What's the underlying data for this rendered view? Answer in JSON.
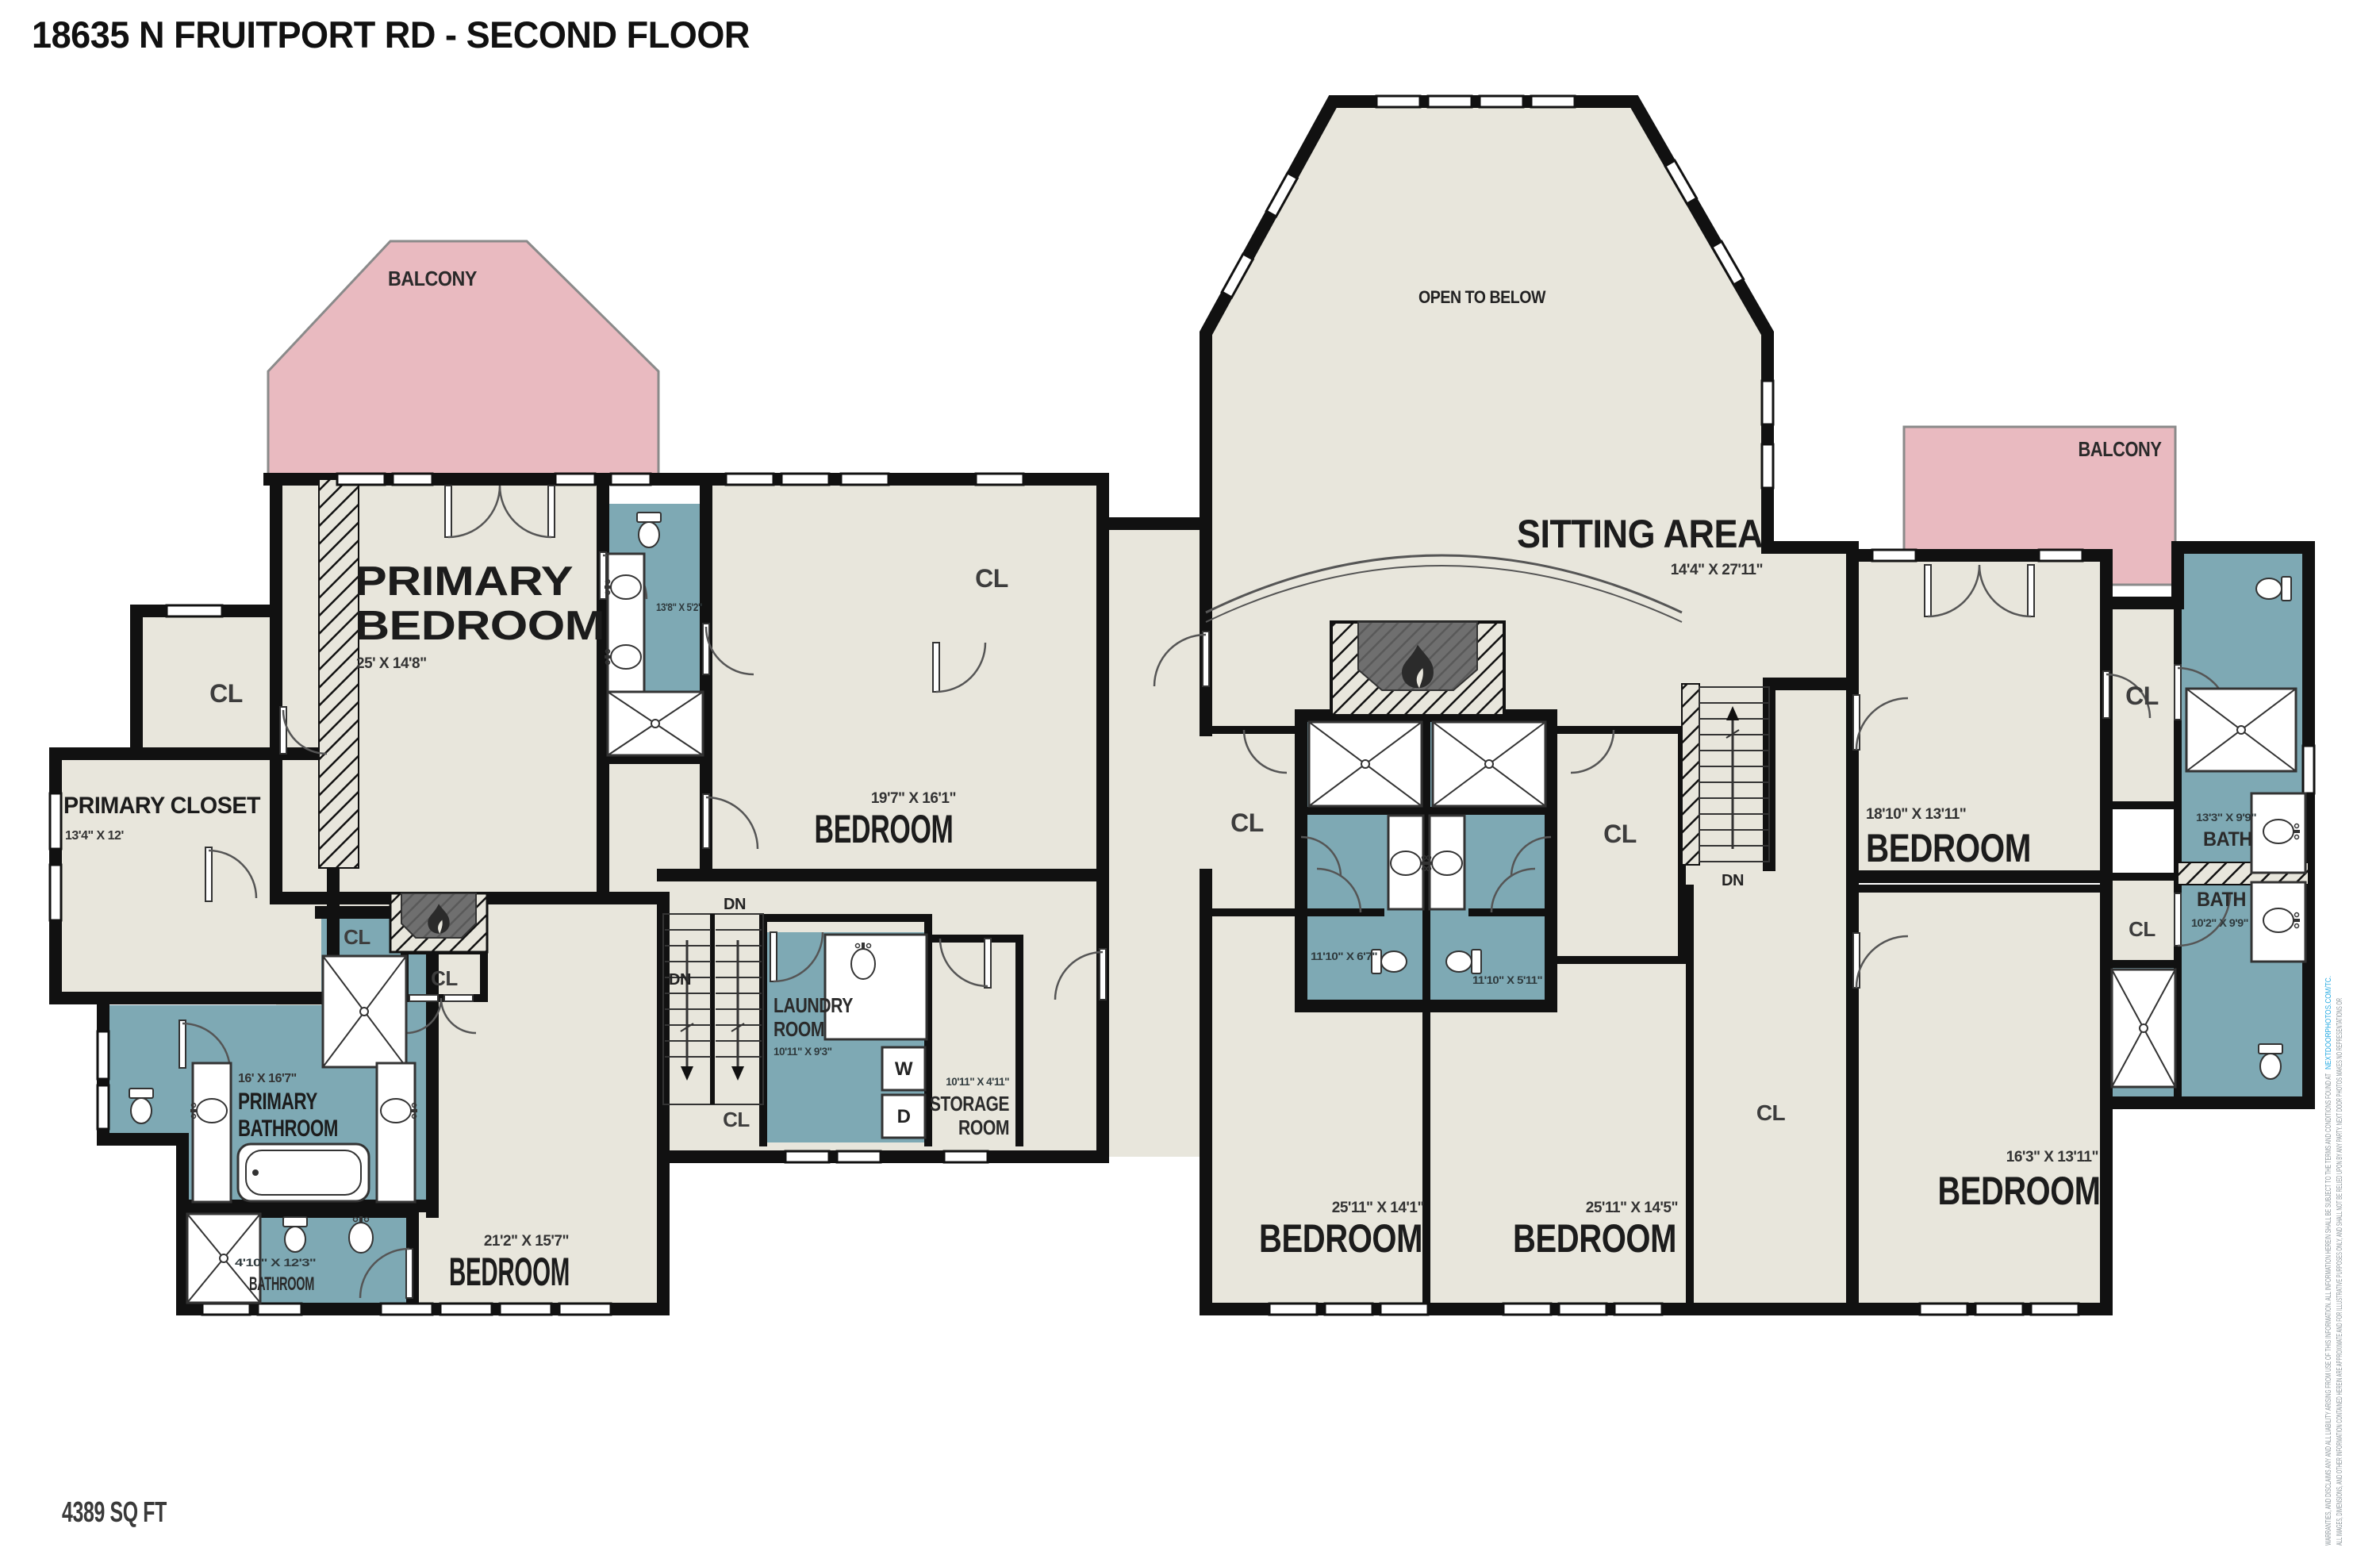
{
  "title": "18635 N FRUITPORT RD - SECOND FLOOR",
  "footer": {
    "area": "4389 SQ FT"
  },
  "colors": {
    "floor": "#e8e6dc",
    "bath_floor": "#7ea9b4",
    "balcony": "#e9bac0",
    "wall": "#111111",
    "fire_gray": "#6f6f6f",
    "link_blue": "#29abe2"
  },
  "labels": {
    "cl": "CL",
    "dn": "DN",
    "open_to_below": "OPEN TO BELOW",
    "sitting_area": "SITTING AREA",
    "sitting_area_dims": "14'4\" X 27'11\"",
    "balcony_left": "BALCONY",
    "balcony_right": "BALCONY",
    "primary_bedroom_1": "PRIMARY",
    "primary_bedroom_2": "BEDROOM",
    "primary_bedroom_dims": "25' X 14'8\"",
    "primary_closet": "PRIMARY CLOSET",
    "primary_closet_dims": "13'4\" X 12'",
    "primary_bathroom_1": "PRIMARY",
    "primary_bathroom_2": "BATHROOM",
    "primary_bathroom_dims": "16' X 16'7\"",
    "ensuite_bath_dims": "13'8\" X 5'2\"",
    "bathroom_small": "BATHROOM",
    "bathroom_small_dims": "4'10\" X 12'3\"",
    "bedroom_bottom_left": "BEDROOM",
    "bedroom_bottom_left_dims": "21'2\" X 15'7\"",
    "bedroom_top_mid": "BEDROOM",
    "bedroom_top_mid_dims": "19'7\" X 16'1\"",
    "laundry_1": "LAUNDRY",
    "laundry_2": "ROOM",
    "laundry_dims": "10'11\" X 9'3\"",
    "washer": "W",
    "dryer": "D",
    "storage_1": "STORAGE",
    "storage_2": "ROOM",
    "storage_dims": "10'11\" X 4'11\"",
    "bath_jj_left_dims": "11'10\" X 6'7\"",
    "bath_jj_right_dims": "11'10\" X 5'11\"",
    "bedroom_bottom_mid1": "BEDROOM",
    "bedroom_bottom_mid1_dims": "25'11\" X 14'1\"",
    "bedroom_bottom_mid2": "BEDROOM",
    "bedroom_bottom_mid2_dims": "25'11\" X 14'5\"",
    "bedroom_right": "BEDROOM",
    "bedroom_right_dims": "18'10\" X 13'11\"",
    "bedroom_bottom_right": "BEDROOM",
    "bedroom_bottom_right_dims": "16'3\" X 13'11\"",
    "bath_right_upper": "BATH",
    "bath_right_upper_dims": "13'3\" X 9'9\"",
    "bath_right_lower": "BATH",
    "bath_right_lower_dims": "10'2\" X 9'9\""
  },
  "disclaimer": {
    "line1": "ALL IMAGES, DIMENSIONS, AND OTHER INFORMATION CONTAINED HEREIN ARE APPROXIMATE AND FOR ILLUSTRATIVE PURPOSES ONLY, AND SHALL NOT BE RELIED UPON BY ANY PARTY. NEXT DOOR PHOTOS MAKES NO REPRESENTATIONS OR",
    "line2": "WARRANTIES, AND DISCLAIMS ANY AND ALL LIABILITY ARISING FROM USE OF THIS INFORMATION. ALL INFORMATION HEREIN SHALL BE SUBJECT TO THE TERMS AND CONDITIONS FOUND AT",
    "link": "NEXTDOORPHOTOS.COM/TC."
  }
}
